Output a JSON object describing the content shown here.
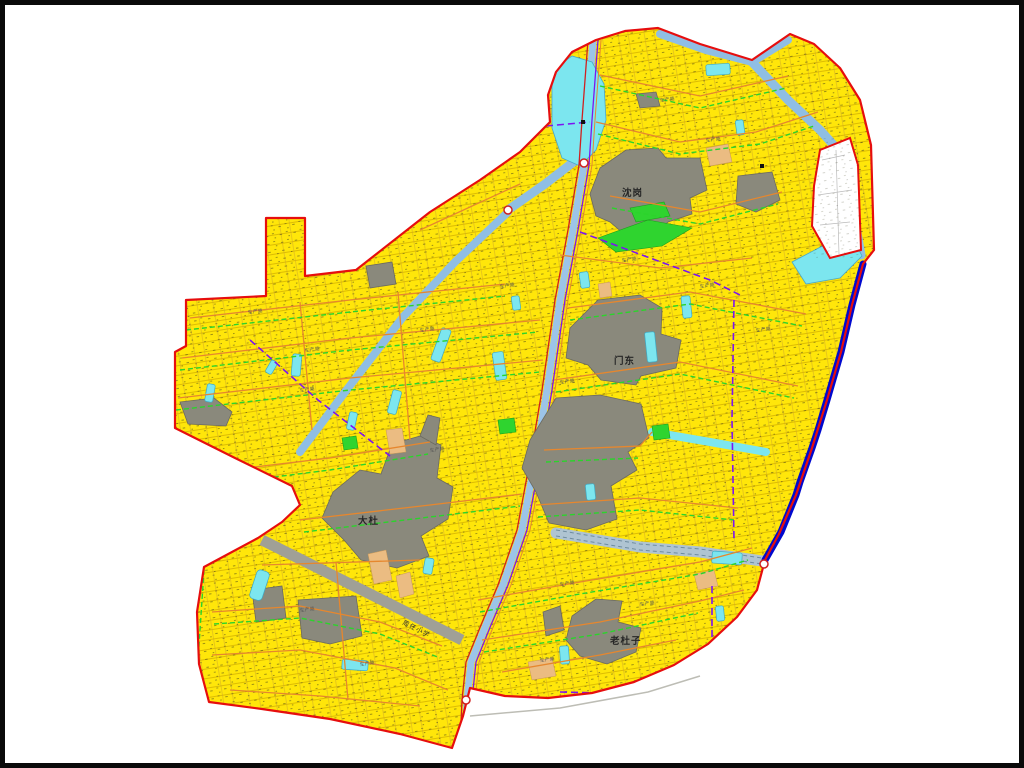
{
  "page": {
    "background": "#ffffff",
    "frame_color": "#000000"
  },
  "map": {
    "type": "land-use / cadastral village map",
    "labels": {
      "village_shengang": "沈岗",
      "village_mendong": "门东",
      "village_dadu": "大杜",
      "village_laoduzi": "老杜子",
      "school": "周任小学",
      "road_generic": "生产路"
    },
    "colors": {
      "farmland_yellow": "#FFE60A",
      "boundary_red": "#E60E0E",
      "river_blue": "#8FBEE4",
      "pond_cyan": "#7CE6EF",
      "village_gray": "#8A897C",
      "canal_dark_blue": "#0009CE",
      "road_orange": "#E6872E",
      "field_green": "#2BD42B",
      "admin_purple": "#7C14F0",
      "orchard_tan": "#EBBC82",
      "gray_road": "#A0A096"
    }
  }
}
